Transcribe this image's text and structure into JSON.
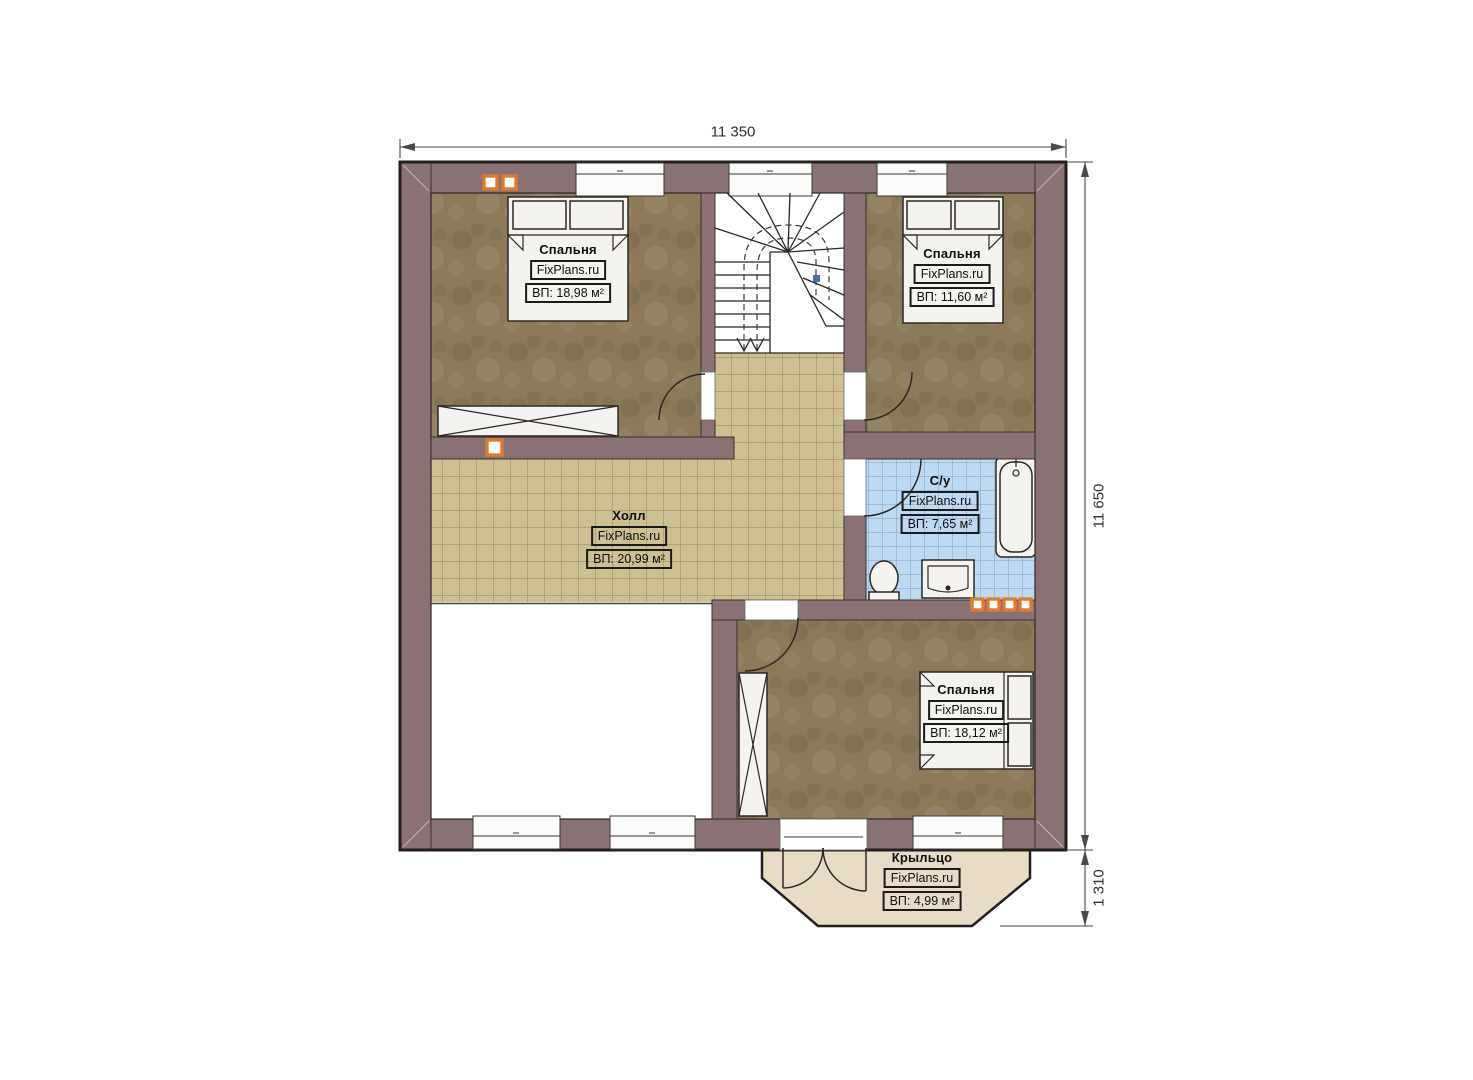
{
  "dimensions": {
    "top": "11 350",
    "right": "11 650",
    "bottom_right": "1 310"
  },
  "rooms": [
    {
      "id": "bedroom-1",
      "name": "Спальня",
      "watermark": "FixPlans.ru",
      "area": "ВП: 18,98 м²"
    },
    {
      "id": "bedroom-2",
      "name": "Спальня",
      "watermark": "FixPlans.ru",
      "area": "ВП: 11,60 м²"
    },
    {
      "id": "hall",
      "name": "Холл",
      "watermark": "FixPlans.ru",
      "area": "ВП: 20,99 м²"
    },
    {
      "id": "bathroom",
      "name": "С/у",
      "watermark": "FixPlans.ru",
      "area": "ВП: 7,65 м²"
    },
    {
      "id": "bedroom-3",
      "name": "Спальня",
      "watermark": "FixPlans.ru",
      "area": "ВП: 18,12 м²"
    },
    {
      "id": "porch",
      "name": "Крыльцо",
      "watermark": "FixPlans.ru",
      "area": "ВП: 4,99 м²"
    }
  ],
  "colors": {
    "wall": "#8a7173",
    "bedroom_floor": "#8b795a",
    "hall_tile": "#cfc094",
    "hall_grid": "#83734d",
    "bath_tile": "#bedaf2",
    "bath_grid": "#7d9cc0",
    "porch_floor": "#e8dcc6",
    "marker": "#e07a2e"
  }
}
